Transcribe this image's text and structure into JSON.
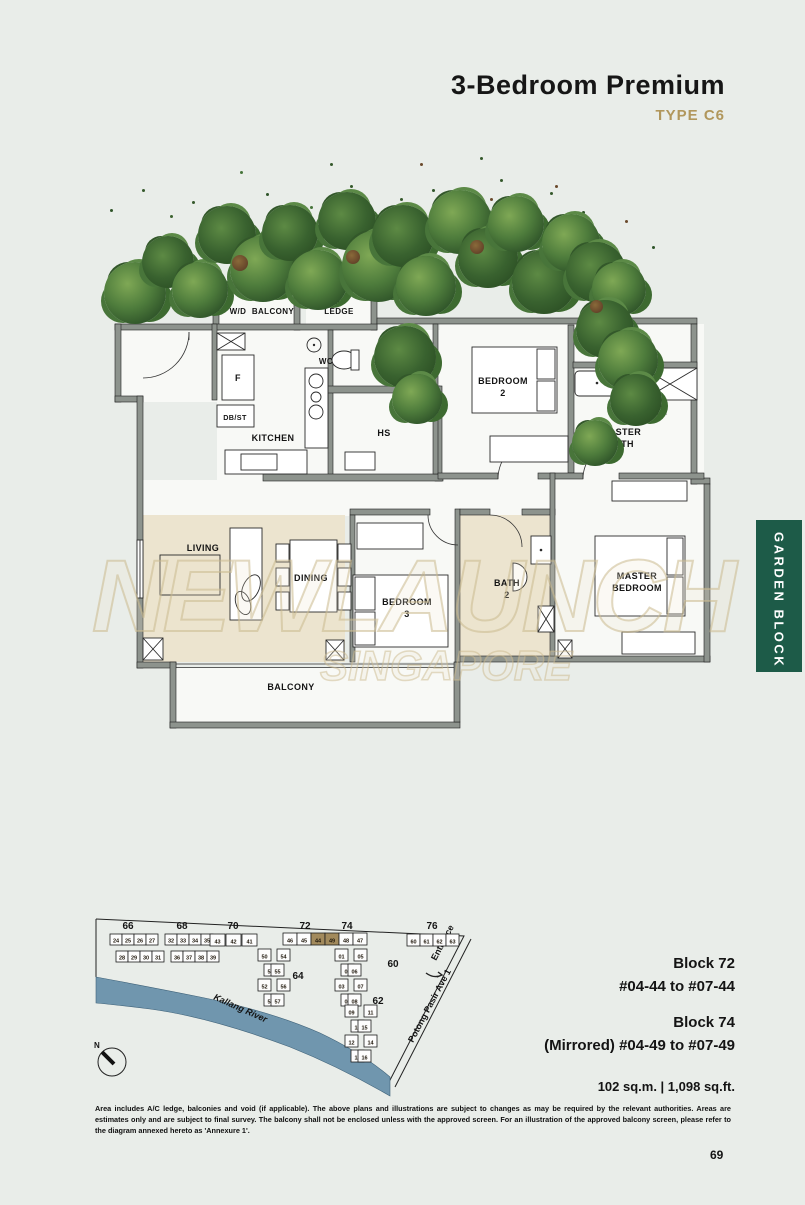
{
  "header": {
    "title": "3-Bedroom Premium",
    "subtitle": "TYPE C6",
    "accent_color": "#b1975c"
  },
  "side_tab": {
    "label": "GARDEN BLOCK",
    "color": "#1d5b48"
  },
  "watermark": {
    "line1": "NEWLAUNCH",
    "line2": "SINGAPORE"
  },
  "floor_plan": {
    "labels": {
      "wd": "W/D",
      "balcony_top": "BALCONY",
      "ac_top_1": "A/C",
      "ac_top_2": "LEDGE",
      "wc": "WC",
      "f": "F",
      "dbst": "DB/ST",
      "kitchen": "KITCHEN",
      "hs": "HS",
      "bedroom2_1": "BEDROOM",
      "bedroom2_2": "2",
      "ac_right_1": "A/C",
      "ac_right_2": "LEDGE",
      "master_bath_1": "MASTER",
      "master_bath_2": "BATH",
      "living": "LIVING",
      "dining": "DINING",
      "bedroom3_1": "BEDROOM",
      "bedroom3_2": "3",
      "bath2_1": "BATH",
      "bath2_2": "2",
      "master_bedroom_1": "MASTER",
      "master_bedroom_2": "BEDROOM",
      "balcony": "BALCONY"
    }
  },
  "site_plan": {
    "river_label": "Kallang River",
    "road_label": "Potong Pasir Ave 1",
    "entrance_label": "Entrance",
    "north_label": "N",
    "highlight_color": "#a28a5c",
    "river_color": "#7096ae",
    "highlighted_units": [
      "44",
      "49"
    ],
    "buildings": [
      {
        "label": "66",
        "lx": 38,
        "ly": 24,
        "boxes": [
          {
            "x": 20,
            "y": 29,
            "w": 12,
            "h": 11,
            "n": "24"
          },
          {
            "x": 32,
            "y": 29,
            "w": 12,
            "h": 11,
            "n": "25"
          },
          {
            "x": 44,
            "y": 29,
            "w": 12,
            "h": 11,
            "n": "26"
          },
          {
            "x": 56,
            "y": 29,
            "w": 12,
            "h": 11,
            "n": "27"
          },
          {
            "x": 26,
            "y": 46,
            "w": 12,
            "h": 11,
            "n": "28"
          },
          {
            "x": 38,
            "y": 46,
            "w": 12,
            "h": 11,
            "n": "29"
          },
          {
            "x": 50,
            "y": 46,
            "w": 12,
            "h": 11,
            "n": "30"
          },
          {
            "x": 62,
            "y": 46,
            "w": 12,
            "h": 11,
            "n": "31"
          }
        ]
      },
      {
        "label": "68",
        "lx": 92,
        "ly": 24,
        "boxes": [
          {
            "x": 75,
            "y": 29,
            "w": 12,
            "h": 11,
            "n": "32"
          },
          {
            "x": 87,
            "y": 29,
            "w": 12,
            "h": 11,
            "n": "33"
          },
          {
            "x": 99,
            "y": 29,
            "w": 12,
            "h": 11,
            "n": "34"
          },
          {
            "x": 111,
            "y": 29,
            "w": 12,
            "h": 11,
            "n": "35"
          },
          {
            "x": 81,
            "y": 46,
            "w": 12,
            "h": 11,
            "n": "36"
          },
          {
            "x": 93,
            "y": 46,
            "w": 12,
            "h": 11,
            "n": "37"
          },
          {
            "x": 105,
            "y": 46,
            "w": 12,
            "h": 11,
            "n": "38"
          },
          {
            "x": 117,
            "y": 46,
            "w": 12,
            "h": 11,
            "n": "39"
          }
        ]
      },
      {
        "label": "70",
        "lx": 143,
        "ly": 24,
        "boxes": [
          {
            "x": 120,
            "y": 29,
            "w": 15,
            "h": 12,
            "n": "43"
          },
          {
            "x": 136,
            "y": 29,
            "w": 15,
            "h": 12,
            "n": "42"
          },
          {
            "x": 152,
            "y": 29,
            "w": 15,
            "h": 12,
            "n": "41"
          }
        ]
      },
      {
        "label": "72",
        "lx": 215,
        "ly": 24,
        "boxes": [
          {
            "x": 193,
            "y": 28,
            "w": 14,
            "h": 12,
            "n": "46"
          },
          {
            "x": 207,
            "y": 28,
            "w": 14,
            "h": 12,
            "n": "45"
          },
          {
            "x": 221,
            "y": 28,
            "w": 14,
            "h": 12,
            "n": "44",
            "hl": true
          }
        ]
      },
      {
        "label": "74",
        "lx": 257,
        "ly": 24,
        "boxes": [
          {
            "x": 235,
            "y": 28,
            "w": 14,
            "h": 12,
            "n": "49",
            "hl": true
          },
          {
            "x": 249,
            "y": 28,
            "w": 14,
            "h": 12,
            "n": "48"
          },
          {
            "x": 263,
            "y": 28,
            "w": 14,
            "h": 12,
            "n": "47"
          }
        ]
      },
      {
        "label": "76",
        "lx": 342,
        "ly": 24,
        "boxes": [
          {
            "x": 317,
            "y": 29,
            "w": 13,
            "h": 12,
            "n": "60"
          },
          {
            "x": 330,
            "y": 29,
            "w": 13,
            "h": 12,
            "n": "61"
          },
          {
            "x": 343,
            "y": 29,
            "w": 13,
            "h": 12,
            "n": "62"
          },
          {
            "x": 356,
            "y": 29,
            "w": 13,
            "h": 12,
            "n": "63"
          }
        ]
      },
      {
        "label": "64",
        "lx": 208,
        "ly": 74,
        "boxes": [
          {
            "x": 168,
            "y": 44,
            "w": 13,
            "h": 12,
            "n": "50"
          },
          {
            "x": 174,
            "y": 59,
            "w": 13,
            "h": 12,
            "n": "51"
          },
          {
            "x": 168,
            "y": 74,
            "w": 13,
            "h": 12,
            "n": "52"
          },
          {
            "x": 174,
            "y": 89,
            "w": 13,
            "h": 12,
            "n": "53"
          },
          {
            "x": 187,
            "y": 44,
            "w": 13,
            "h": 12,
            "n": "54"
          },
          {
            "x": 181,
            "y": 59,
            "w": 13,
            "h": 12,
            "n": "55"
          },
          {
            "x": 187,
            "y": 74,
            "w": 13,
            "h": 12,
            "n": "56"
          },
          {
            "x": 181,
            "y": 89,
            "w": 13,
            "h": 12,
            "n": "57"
          }
        ]
      },
      {
        "label": "60",
        "lx": 303,
        "ly": 62,
        "boxes": [
          {
            "x": 245,
            "y": 44,
            "w": 13,
            "h": 12,
            "n": "01"
          },
          {
            "x": 251,
            "y": 59,
            "w": 13,
            "h": 12,
            "n": "02"
          },
          {
            "x": 245,
            "y": 74,
            "w": 13,
            "h": 12,
            "n": "03"
          },
          {
            "x": 251,
            "y": 89,
            "w": 13,
            "h": 12,
            "n": "04"
          },
          {
            "x": 264,
            "y": 44,
            "w": 13,
            "h": 12,
            "n": "05"
          },
          {
            "x": 258,
            "y": 59,
            "w": 13,
            "h": 12,
            "n": "06"
          },
          {
            "x": 264,
            "y": 74,
            "w": 13,
            "h": 12,
            "n": "07"
          },
          {
            "x": 258,
            "y": 89,
            "w": 13,
            "h": 12,
            "n": "08"
          }
        ]
      },
      {
        "label": "62",
        "lx": 288,
        "ly": 99,
        "boxes": [
          {
            "x": 255,
            "y": 100,
            "w": 13,
            "h": 12,
            "n": "09"
          },
          {
            "x": 261,
            "y": 115,
            "w": 13,
            "h": 12,
            "n": "10"
          },
          {
            "x": 255,
            "y": 130,
            "w": 13,
            "h": 12,
            "n": "12"
          },
          {
            "x": 261,
            "y": 145,
            "w": 13,
            "h": 12,
            "n": "13"
          },
          {
            "x": 274,
            "y": 100,
            "w": 13,
            "h": 12,
            "n": "11"
          },
          {
            "x": 268,
            "y": 115,
            "w": 13,
            "h": 12,
            "n": "15"
          },
          {
            "x": 274,
            "y": 130,
            "w": 13,
            "h": 12,
            "n": "14"
          },
          {
            "x": 268,
            "y": 145,
            "w": 13,
            "h": 12,
            "n": "16"
          }
        ]
      }
    ]
  },
  "info": {
    "block72_title": "Block 72",
    "block72_units": "#04-44 to #07-44",
    "block74_title": "Block 74",
    "block74_units": "(Mirrored) #04-49 to #07-49",
    "area": "102 sq.m.   |   1,098 sq.ft."
  },
  "disclaimer": "Area includes A/C ledge, balconies and void (if applicable). The above plans and illustrations are subject to changes as may be required by the relevant authorities. Areas are estimates only and are subject to final survey. The balcony shall not be enclosed unless with the approved screen. For an illustration of the approved balcony screen, please refer to the diagram annexed hereto as 'Annexure 1'.",
  "page_number": "69"
}
